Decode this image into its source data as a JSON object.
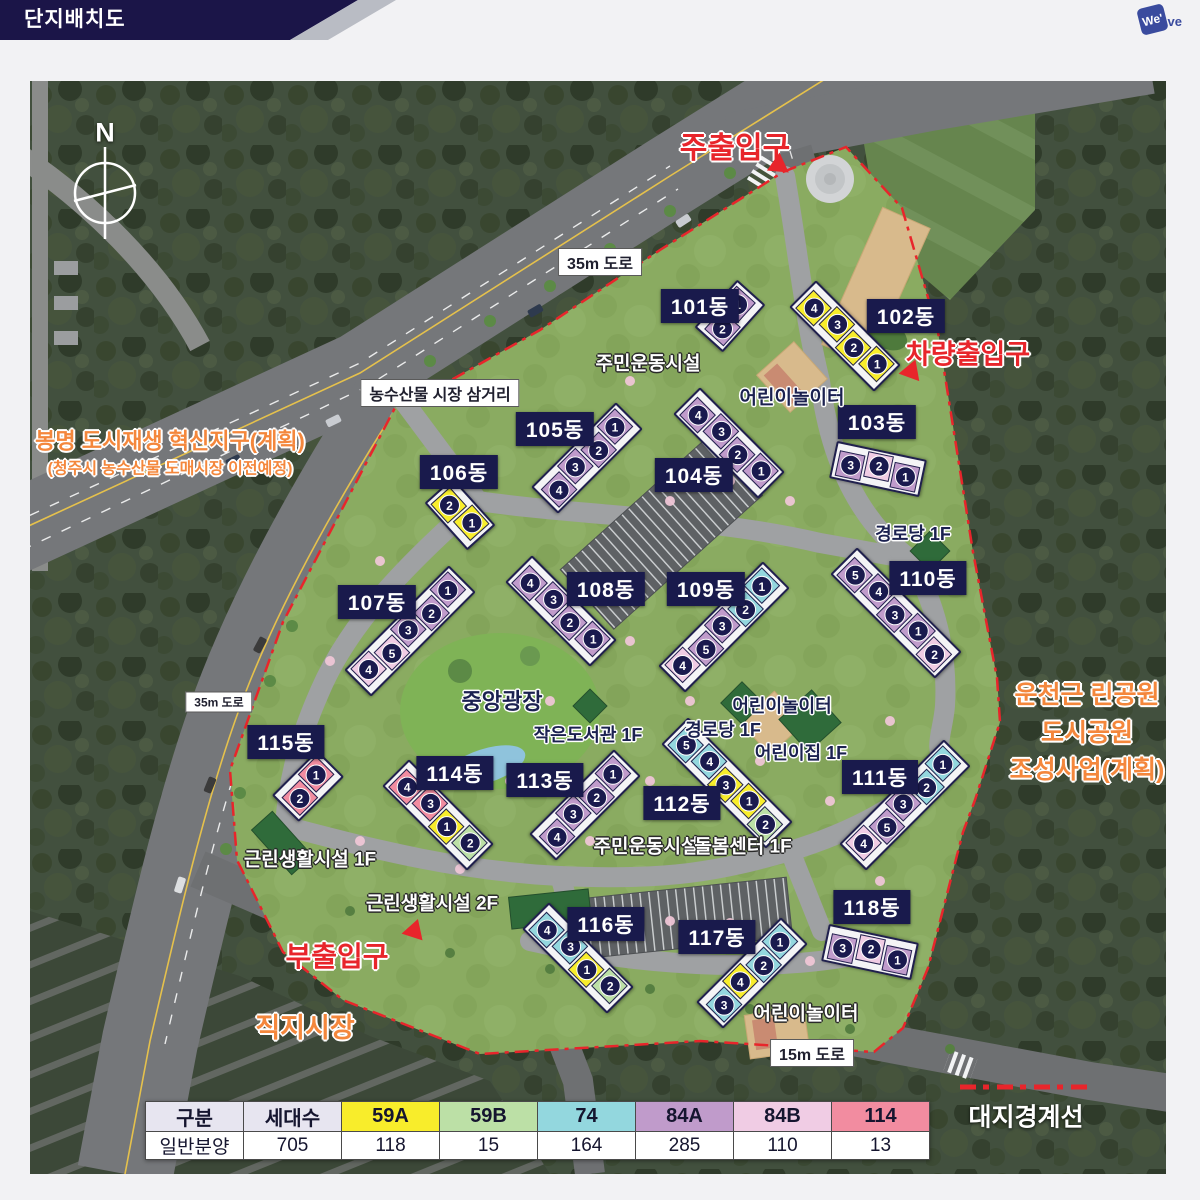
{
  "colors": {
    "topbar_navy": "#1B1548",
    "topbar_silver": "#B9BCC4",
    "label_navy": "#191A4C",
    "boundary_red": "#E8252B",
    "planned_orange": "#F4873C",
    "logo_blue": "#3A4B9E"
  },
  "header": {
    "title": "단지배치도",
    "logo_square": "We'",
    "logo_tail": "ve"
  },
  "compass": {
    "label": "N"
  },
  "unit_colors": {
    "59A": "#F8ED2B",
    "59B": "#BCE0A6",
    "74": "#93D7DE",
    "84A": "#C09BCB",
    "84B": "#F0CCE4",
    "114": "#F28CA0"
  },
  "map": {
    "buildings": [
      {
        "name": "101동",
        "label": {
          "x": 670,
          "y": 225
        },
        "bar": {
          "x": 700,
          "y": 235,
          "angle": 42
        },
        "units": [
          {
            "no": "1",
            "type": "84A"
          },
          {
            "no": "2",
            "type": "84A"
          }
        ]
      },
      {
        "name": "102동",
        "label": {
          "x": 876,
          "y": 235
        },
        "bar": {
          "x": 815,
          "y": 255,
          "angle": -45
        },
        "units": [
          {
            "no": "4",
            "type": "59A"
          },
          {
            "no": "3",
            "type": "59A"
          },
          {
            "no": "2",
            "type": "59A"
          },
          {
            "no": "1",
            "type": "59A"
          }
        ]
      },
      {
        "name": "103동",
        "label": {
          "x": 847,
          "y": 341
        },
        "bar": {
          "x": 848,
          "y": 388,
          "angle": -78
        },
        "units": [
          {
            "no": "3",
            "type": "84A"
          },
          {
            "no": "2",
            "type": "84B"
          },
          {
            "no": "1",
            "type": "84A"
          }
        ]
      },
      {
        "name": "104동",
        "label": {
          "x": 664,
          "y": 394
        },
        "bar": {
          "x": 699,
          "y": 362,
          "angle": -45
        },
        "units": [
          {
            "no": "4",
            "type": "84A"
          },
          {
            "no": "3",
            "type": "84A"
          },
          {
            "no": "2",
            "type": "84A"
          },
          {
            "no": "1",
            "type": "84A"
          }
        ]
      },
      {
        "name": "105동",
        "label": {
          "x": 525,
          "y": 348
        },
        "bar": {
          "x": 557,
          "y": 377,
          "angle": 45
        },
        "units": [
          {
            "no": "1",
            "type": "84A"
          },
          {
            "no": "2",
            "type": "84A"
          },
          {
            "no": "3",
            "type": "84A"
          },
          {
            "no": "4",
            "type": "84A"
          }
        ]
      },
      {
        "name": "106동",
        "label": {
          "x": 429,
          "y": 391
        },
        "bar": {
          "x": 430,
          "y": 433,
          "angle": -42
        },
        "units": [
          {
            "no": "2",
            "type": "59A"
          },
          {
            "no": "1",
            "type": "59A"
          }
        ]
      },
      {
        "name": "107동",
        "label": {
          "x": 347,
          "y": 521
        },
        "bar": {
          "x": 380,
          "y": 550,
          "angle": 45
        },
        "units": [
          {
            "no": "1",
            "type": "84A"
          },
          {
            "no": "2",
            "type": "84A"
          },
          {
            "no": "3",
            "type": "84A"
          },
          {
            "no": "5",
            "type": "84B"
          },
          {
            "no": "4",
            "type": "84B"
          }
        ]
      },
      {
        "name": "108동",
        "label": {
          "x": 576,
          "y": 508
        },
        "bar": {
          "x": 531,
          "y": 530,
          "angle": -45
        },
        "units": [
          {
            "no": "4",
            "type": "84A"
          },
          {
            "no": "3",
            "type": "84A"
          },
          {
            "no": "2",
            "type": "84A"
          },
          {
            "no": "1",
            "type": "84A"
          }
        ]
      },
      {
        "name": "109동",
        "label": {
          "x": 676,
          "y": 508
        },
        "bar": {
          "x": 694,
          "y": 546,
          "angle": 45
        },
        "units": [
          {
            "no": "1",
            "type": "74"
          },
          {
            "no": "2",
            "type": "74"
          },
          {
            "no": "3",
            "type": "84A"
          },
          {
            "no": "5",
            "type": "84A"
          },
          {
            "no": "4",
            "type": "84B"
          }
        ]
      },
      {
        "name": "110동",
        "label": {
          "x": 898,
          "y": 497
        },
        "bar": {
          "x": 866,
          "y": 532,
          "angle": -45
        },
        "units": [
          {
            "no": "5",
            "type": "84A"
          },
          {
            "no": "4",
            "type": "84A"
          },
          {
            "no": "3",
            "type": "84A"
          },
          {
            "no": "1",
            "type": "84A"
          },
          {
            "no": "2",
            "type": "84B"
          }
        ]
      },
      {
        "name": "111동",
        "label": {
          "x": 850,
          "y": 696
        },
        "bar": {
          "x": 875,
          "y": 724,
          "angle": 45
        },
        "units": [
          {
            "no": "1",
            "type": "74"
          },
          {
            "no": "2",
            "type": "74"
          },
          {
            "no": "3",
            "type": "84A"
          },
          {
            "no": "5",
            "type": "84A"
          },
          {
            "no": "4",
            "type": "84B"
          }
        ]
      },
      {
        "name": "112동",
        "label": {
          "x": 652,
          "y": 722
        },
        "bar": {
          "x": 697,
          "y": 702,
          "angle": -45
        },
        "units": [
          {
            "no": "5",
            "type": "74"
          },
          {
            "no": "4",
            "type": "74"
          },
          {
            "no": "3",
            "type": "59A"
          },
          {
            "no": "1",
            "type": "59A"
          },
          {
            "no": "2",
            "type": "59B"
          }
        ]
      },
      {
        "name": "113동",
        "label": {
          "x": 515,
          "y": 699
        },
        "bar": {
          "x": 555,
          "y": 724,
          "angle": 45
        },
        "units": [
          {
            "no": "1",
            "type": "84A"
          },
          {
            "no": "2",
            "type": "84A"
          },
          {
            "no": "3",
            "type": "84A"
          },
          {
            "no": "4",
            "type": "84A"
          }
        ]
      },
      {
        "name": "114동",
        "label": {
          "x": 425,
          "y": 692
        },
        "bar": {
          "x": 408,
          "y": 734,
          "angle": -45
        },
        "units": [
          {
            "no": "4",
            "type": "114"
          },
          {
            "no": "3",
            "type": "114"
          },
          {
            "no": "1",
            "type": "59A"
          },
          {
            "no": "2",
            "type": "59B"
          }
        ]
      },
      {
        "name": "115동",
        "label": {
          "x": 256,
          "y": 661
        },
        "bar": {
          "x": 278,
          "y": 705,
          "angle": 45
        },
        "units": [
          {
            "no": "1",
            "type": "114"
          },
          {
            "no": "2",
            "type": "114"
          }
        ]
      },
      {
        "name": "116동",
        "label": {
          "x": 576,
          "y": 843
        },
        "bar": {
          "x": 548,
          "y": 877,
          "angle": -45
        },
        "units": [
          {
            "no": "4",
            "type": "74"
          },
          {
            "no": "3",
            "type": "74"
          },
          {
            "no": "1",
            "type": "59A"
          },
          {
            "no": "2",
            "type": "59B"
          }
        ]
      },
      {
        "name": "117동",
        "label": {
          "x": 687,
          "y": 856
        },
        "bar": {
          "x": 722,
          "y": 892,
          "angle": 45
        },
        "units": [
          {
            "no": "1",
            "type": "74"
          },
          {
            "no": "2",
            "type": "74"
          },
          {
            "no": "4",
            "type": "59A"
          },
          {
            "no": "3",
            "type": "74"
          }
        ]
      },
      {
        "name": "118동",
        "label": {
          "x": 842,
          "y": 826
        },
        "bar": {
          "x": 840,
          "y": 871,
          "angle": -78
        },
        "units": [
          {
            "no": "3",
            "type": "84A"
          },
          {
            "no": "2",
            "type": "84B"
          },
          {
            "no": "1",
            "type": "84A"
          }
        ]
      }
    ],
    "entrances": [
      {
        "text": "주출입구",
        "x": 705,
        "y": 64,
        "size": 30,
        "tri": {
          "x": 751,
          "y": 86,
          "angle": 125
        }
      },
      {
        "text": "차량출입구",
        "x": 938,
        "y": 271,
        "size": 27,
        "tri": {
          "x": 878,
          "y": 291,
          "angle": -100
        }
      },
      {
        "text": "부출입구",
        "x": 307,
        "y": 874,
        "size": 28,
        "tri": {
          "x": 385,
          "y": 847,
          "angle": 18
        }
      }
    ],
    "planned": [
      {
        "x": 140,
        "y": 372,
        "lines": [
          {
            "text": "봉명 도시재생 혁신지구(계획)",
            "size": 22
          },
          {
            "text": "(청주시 농수산물 도매시장 이전예정)",
            "size": 16
          }
        ]
      },
      {
        "x": 1057,
        "y": 652,
        "lines": [
          {
            "text": "운천근 린공원",
            "size": 25
          },
          {
            "text": "도시공원",
            "size": 25
          },
          {
            "text": "조성사업(계획)",
            "size": 25
          }
        ]
      },
      {
        "x": 275,
        "y": 947,
        "lines": [
          {
            "text": "직지시장",
            "size": 27
          }
        ]
      }
    ],
    "road_labels": [
      {
        "text": "35m 도로",
        "x": 570,
        "y": 181,
        "size": 16
      },
      {
        "text": "농수산물 시장 삼거리",
        "x": 410,
        "y": 312,
        "size": 16
      },
      {
        "text": "35m 도로",
        "x": 189,
        "y": 621,
        "size": 12
      },
      {
        "text": "15m 도로",
        "x": 782,
        "y": 972,
        "size": 16
      }
    ],
    "facilities": [
      {
        "text": "주민운동시설",
        "x": 618,
        "y": 281,
        "style": "light",
        "size": 19
      },
      {
        "text": "어린이놀이터",
        "x": 762,
        "y": 315,
        "style": "dark",
        "size": 19
      },
      {
        "text": "경로당 1F",
        "x": 883,
        "y": 452,
        "style": "dark",
        "size": 18
      },
      {
        "text": "중앙광장",
        "x": 472,
        "y": 619,
        "style": "dark",
        "size": 22
      },
      {
        "text": "작은도서관 1F",
        "x": 558,
        "y": 653,
        "style": "dark",
        "size": 18
      },
      {
        "text": "어린이놀이터",
        "x": 752,
        "y": 624,
        "style": "dark",
        "size": 18
      },
      {
        "text": "경로당 1F",
        "x": 693,
        "y": 648,
        "style": "dark",
        "size": 18
      },
      {
        "text": "어린이집 1F",
        "x": 771,
        "y": 671,
        "style": "dark",
        "size": 18
      },
      {
        "text": "근린생활시설 1F",
        "x": 280,
        "y": 777,
        "style": "light",
        "size": 19
      },
      {
        "text": "근린생활시설 2F",
        "x": 402,
        "y": 821,
        "style": "light",
        "size": 19
      },
      {
        "text": "주민운동시설",
        "x": 616,
        "y": 764,
        "style": "light",
        "size": 19
      },
      {
        "text": "돌봄센터 1F",
        "x": 713,
        "y": 764,
        "style": "light",
        "size": 19
      },
      {
        "text": "어린이놀이터",
        "x": 776,
        "y": 931,
        "style": "light",
        "size": 19
      }
    ],
    "boundary_legend": {
      "text": "대지경계선",
      "x": 996,
      "y": 1062
    }
  },
  "legend_table": {
    "columns": [
      {
        "label": "구분",
        "bg": "#E7E5F0"
      },
      {
        "label": "세대수",
        "bg": "#E7E5F0"
      },
      {
        "label": "59A",
        "bg": "#F8ED2B"
      },
      {
        "label": "59B",
        "bg": "#BCE0A6"
      },
      {
        "label": "74",
        "bg": "#93D7DE"
      },
      {
        "label": "84A",
        "bg": "#C09BCB"
      },
      {
        "label": "84B",
        "bg": "#F0CCE4"
      },
      {
        "label": "114",
        "bg": "#F28CA0"
      }
    ],
    "row": [
      "일반분양",
      "705",
      "118",
      "15",
      "164",
      "285",
      "110",
      "13"
    ]
  }
}
